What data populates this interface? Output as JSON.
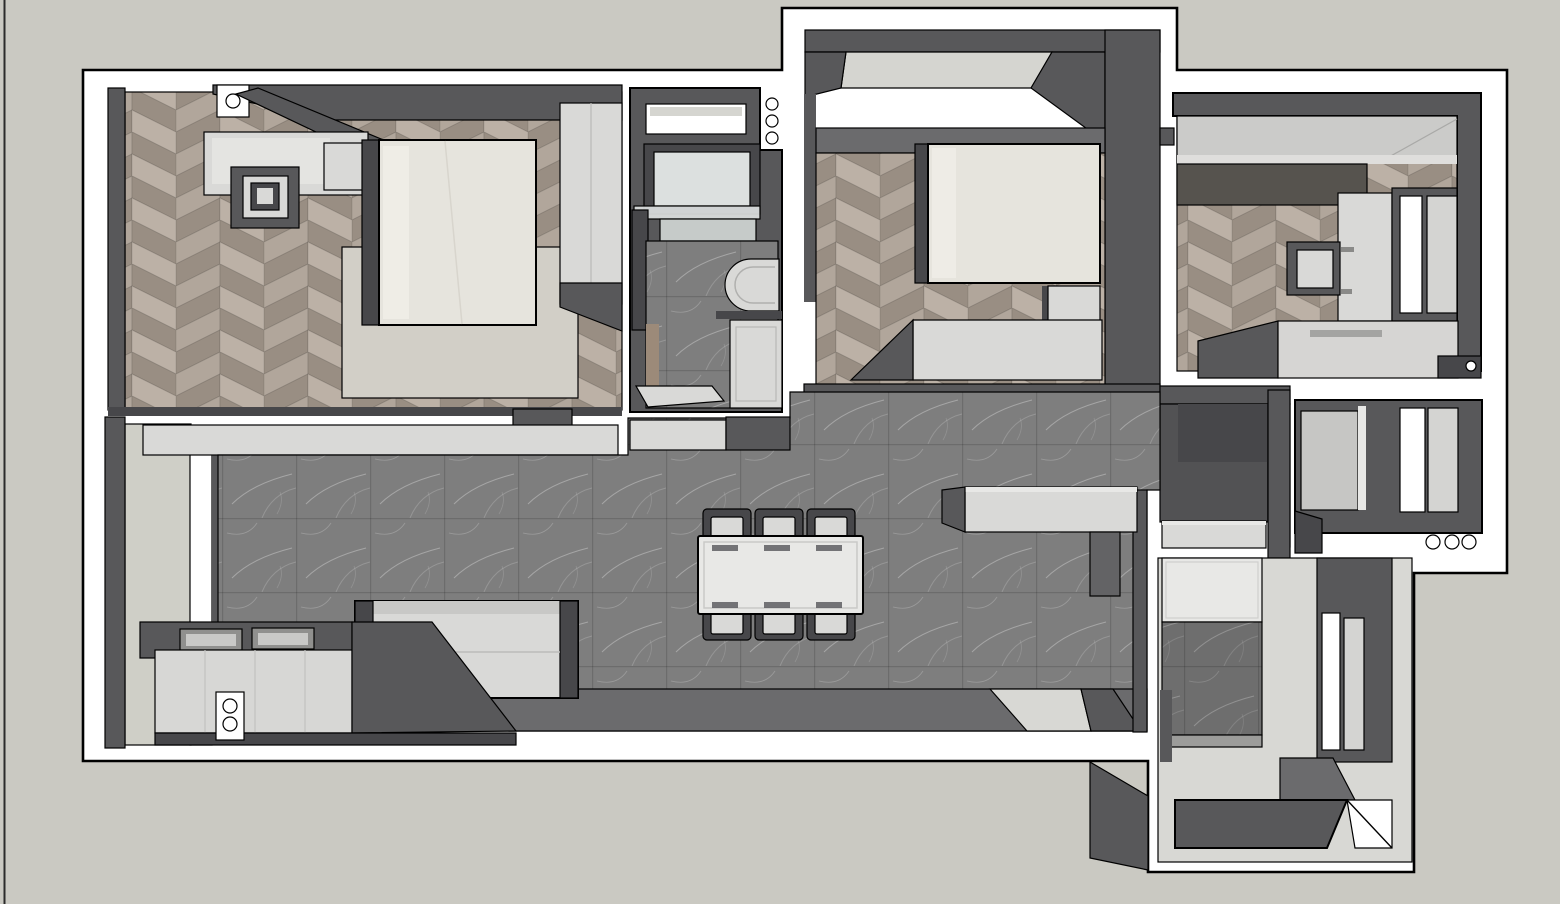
{
  "scene": {
    "type": "3d-floor-plan-render",
    "view": "top-down axonometric",
    "description": "Top-down 3D architectural render (SketchUp style) of an apartment: two bedrooms, a study, bathroom, kitchen, living-dining room, two balconies and an entry foyer. No UI chrome or text is visible.",
    "visible_text": []
  },
  "palette": {
    "background": "#cac9c2",
    "backdrop_line": "#2b2b2b",
    "slab": "#ffffff",
    "outline": "#000000",
    "wall": "#58585a",
    "wall_light": "#6b6b6d",
    "wall_dark": "#47474a",
    "wall_inner_shade": "#47474a",
    "kitchen_interior": "#525254",
    "wood_base": "#a3988d",
    "wood_plank_a": "#b1a69b",
    "wood_plank_b": "#998e83",
    "wood_plank_c": "#bcb1a6",
    "wood_sliver": "#9c8a79",
    "tile_base": "#7e7e7e",
    "tile_seam": "#000000",
    "tile_vein": "#ffffff",
    "cream": "#e6e4dd",
    "pillow": "#f0eee8",
    "rug": "#d2cfc7",
    "furniture_light": "#d9d9d7",
    "furniture_lighter": "#e8e8e6",
    "furniture_mid": "#c8c8c6",
    "glass": "#dce0df",
    "glass_dim": "#c6cbc9",
    "sill": "#d5d5d0",
    "pale_floor": "#cfcfc7",
    "foyer_floor": "#d8d8d4",
    "foyer_band": "#9c9c9a",
    "wardrobe3": "#cbcbc9",
    "wardrobe3_strip": "#dfdedc",
    "dark_cabinet_band": "#56534e",
    "pane_left": "#c6c6c4",
    "pane_right": "#d4d4d2",
    "sink_well": "#90908e",
    "sink_bottom": "#c9c9c7",
    "counter_front": "#d7d7d5",
    "pillar": "#636365",
    "bench3": "#d6d5d3",
    "white": "#ffffff"
  },
  "rooms": [
    {
      "id": "master-bedroom",
      "name": "Master Bedroom",
      "floor": "herringbone wood",
      "furniture": [
        "double bed",
        "rug",
        "wardrobe",
        "vanity desk",
        "vanity chair",
        "nightstand",
        "open door"
      ]
    },
    {
      "id": "bathroom",
      "name": "Bathroom",
      "floor": "dark stone tile",
      "furniture": [
        "mirror vanity",
        "glass counter",
        "toilet",
        "shower tray",
        "window",
        "low shelf"
      ]
    },
    {
      "id": "bedroom-2",
      "name": "Bedroom 2",
      "floor": "herringbone wood",
      "furniture": [
        "bed",
        "foot bench",
        "dresser",
        "window with sill"
      ]
    },
    {
      "id": "bedroom-3",
      "name": "Study / Bedroom 3",
      "floor": "herringbone wood",
      "furniture": [
        "wide wardrobe",
        "desk",
        "chair",
        "bench bed",
        "casement window"
      ]
    },
    {
      "id": "living-dining",
      "name": "Living / Dining Room",
      "floor": "dark stone tile",
      "furniture": [
        "dining table",
        "six dining chairs",
        "sofa",
        "twin-sink counter",
        "island counter",
        "north shelf",
        "ceiling beam"
      ]
    },
    {
      "id": "kitchen",
      "name": "Kitchen",
      "floor": "dark stone tile",
      "furniture": [
        "counter slab"
      ]
    },
    {
      "id": "balcony-left",
      "name": "West Balcony",
      "floor": "pale screed",
      "furniture": [
        "full-height window strip"
      ]
    },
    {
      "id": "balcony-right",
      "name": "East Balcony / AC Ledge",
      "floor": "concrete",
      "furniture": [
        "sliding window",
        "fixed pane"
      ]
    },
    {
      "id": "entry-foyer",
      "name": "Entry Foyer",
      "floor": "light stone tile",
      "furniture": [
        "shoe cabinet",
        "dark tile mat",
        "entry steps",
        "entry door leaf",
        "window"
      ]
    }
  ],
  "markers": {
    "description": "small white pivot/hinge circles drawn on the plan",
    "bathroom_side_circles": 3,
    "balcony_right_circles": 3,
    "counter_switch_circles": 2,
    "master_door_pivot_circles": 1,
    "bedroom3_pivot_circles": 1
  },
  "dining": {
    "table_seats": 6,
    "chairs_top_row": 3,
    "chairs_bottom_row": 3
  }
}
